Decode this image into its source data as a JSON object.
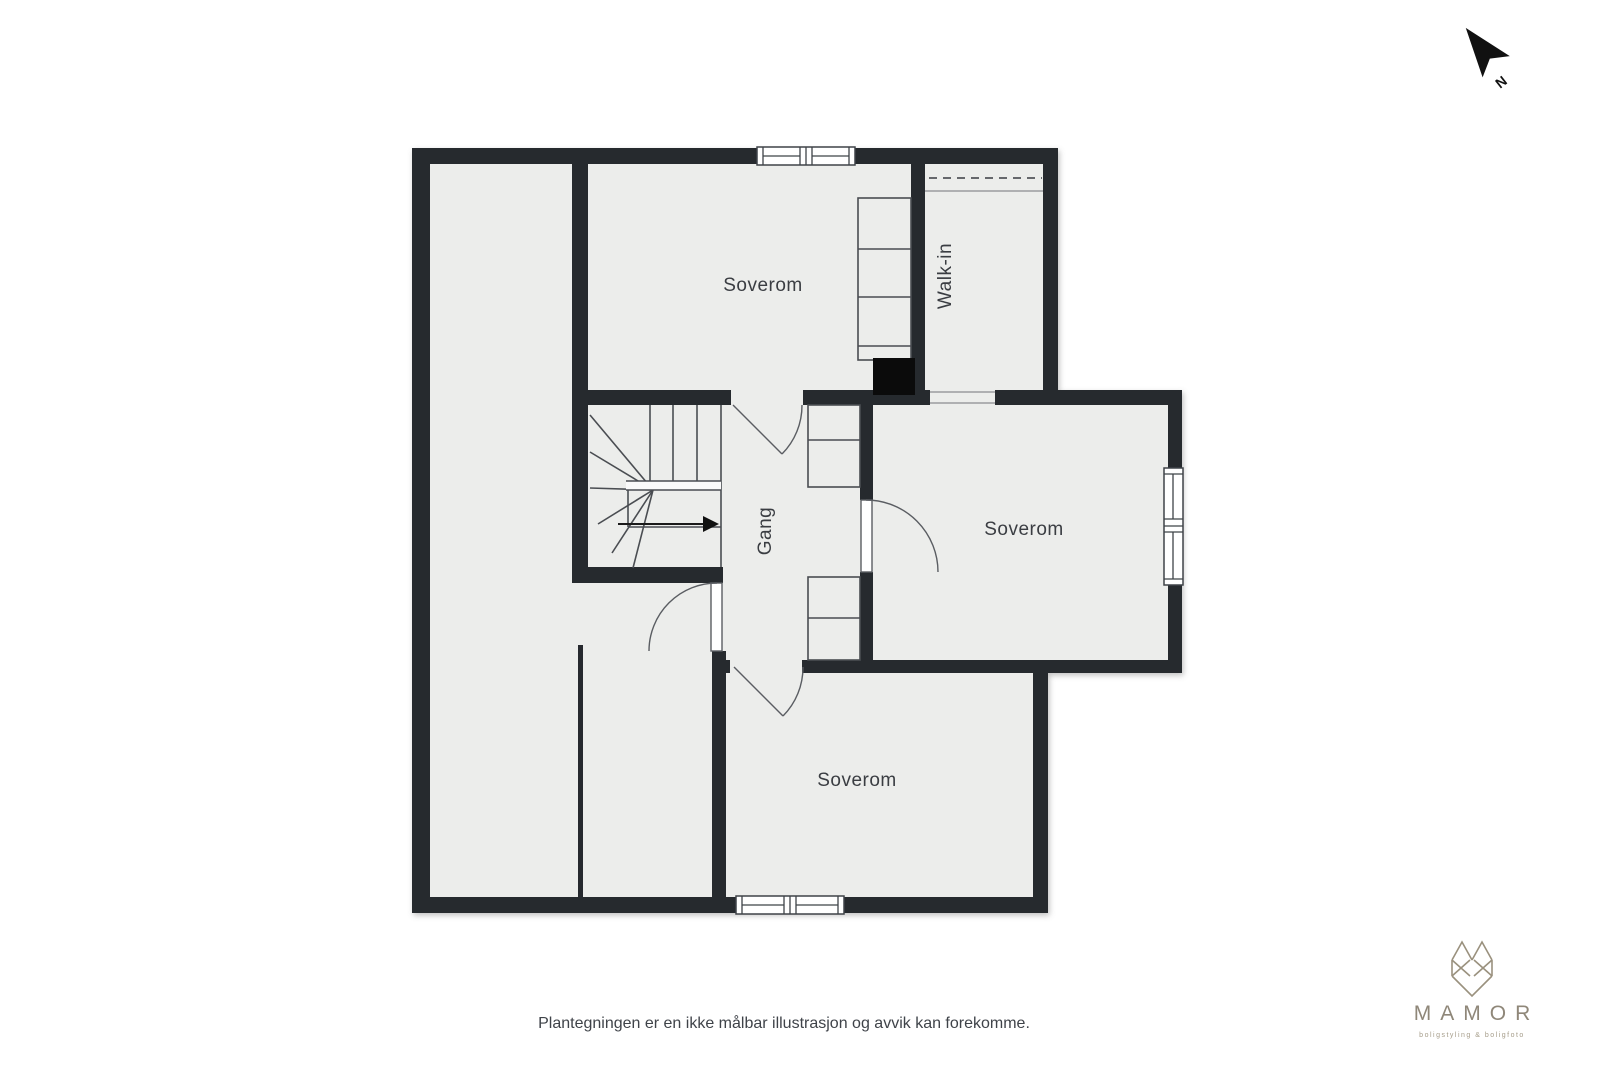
{
  "colors": {
    "wall": "#26292e",
    "floor": "#ecedeb",
    "line": "#4a4d52",
    "label": "#3a3d42",
    "logo": "#9a917e",
    "logotext": "#8f8779",
    "footer": "#3f4349",
    "ink": "#111111"
  },
  "floorplan": {
    "type": "floor-plan",
    "rooms": [
      {
        "id": "soverom-top",
        "label": "Soverom",
        "orientation": "horizontal"
      },
      {
        "id": "walk-in",
        "label": "Walk-in",
        "orientation": "vertical"
      },
      {
        "id": "gang",
        "label": "Gang",
        "orientation": "vertical"
      },
      {
        "id": "soverom-right",
        "label": "Soverom",
        "orientation": "horizontal"
      },
      {
        "id": "soverom-bottom",
        "label": "Soverom",
        "orientation": "horizontal"
      }
    ]
  },
  "compass": {
    "label": "N"
  },
  "footer": {
    "disclaimer": "Plantegningen er en ikke målbar illustrasjon og avvik kan forekomme."
  },
  "logo": {
    "name": "MAMOR",
    "tagline": "boligstyling & boligfoto"
  }
}
